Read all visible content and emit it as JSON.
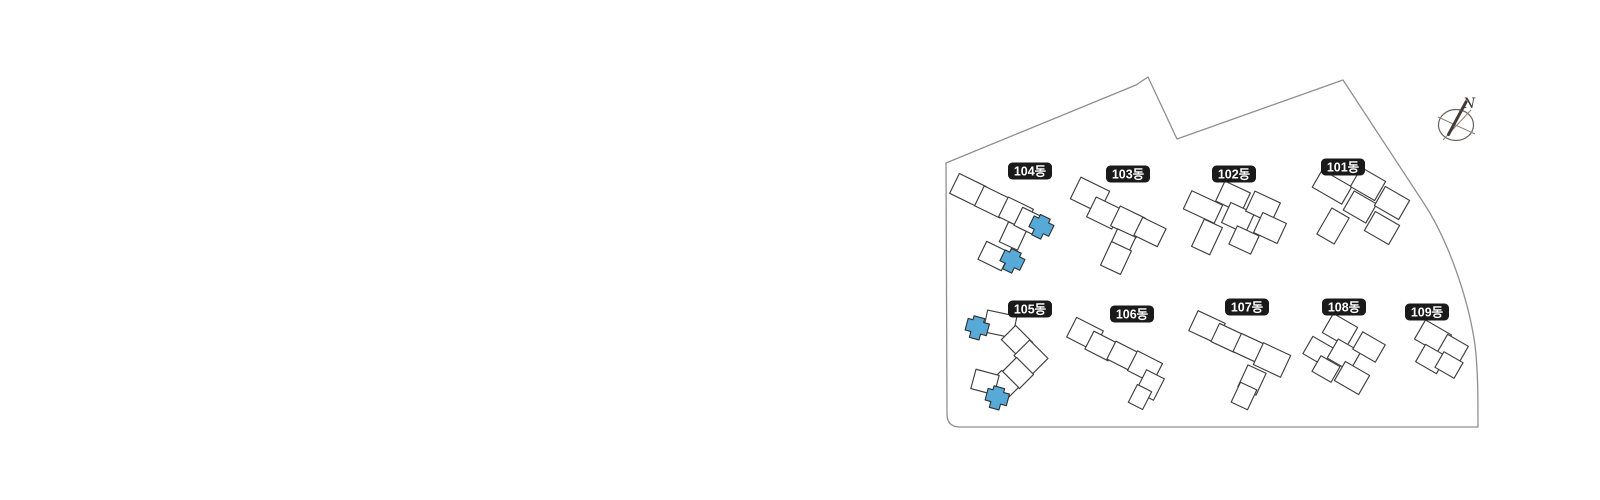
{
  "site_plan": {
    "compass_label": "N",
    "buildings": [
      {
        "name": "101동",
        "highlighted": false
      },
      {
        "name": "102동",
        "highlighted": false
      },
      {
        "name": "103동",
        "highlighted": false
      },
      {
        "name": "104동",
        "highlighted": true
      },
      {
        "name": "105동",
        "highlighted": true
      },
      {
        "name": "106동",
        "highlighted": false
      },
      {
        "name": "107동",
        "highlighted": false
      },
      {
        "name": "108동",
        "highlighted": false
      },
      {
        "name": "109동",
        "highlighted": false
      }
    ],
    "colors": {
      "highlight_unit": "#57a9d8",
      "badge_bg": "#1a1a1a",
      "badge_text": "#ffffff",
      "building_outline": "#3f3f3f",
      "boundary_line": "#8f8f8f"
    }
  }
}
